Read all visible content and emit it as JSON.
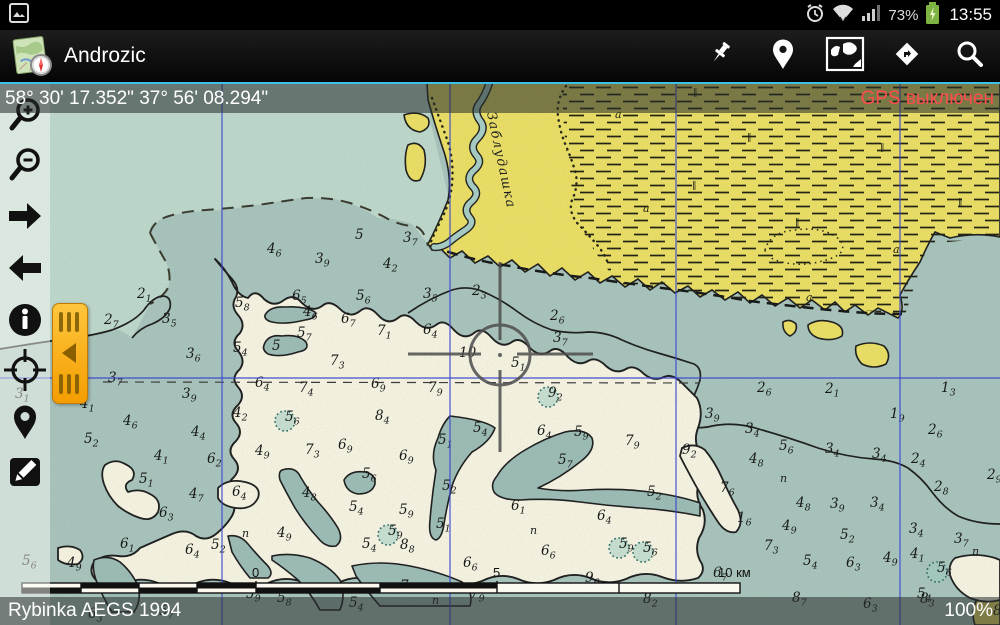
{
  "status_bar": {
    "time": "13:55",
    "battery_percent": "73%",
    "icons": [
      "screenshot-icon",
      "alarm-icon",
      "wifi-icon",
      "signal-icon",
      "battery-charging-icon"
    ]
  },
  "action_bar": {
    "title": "Androzic",
    "buttons": [
      {
        "name": "pushpin-button"
      },
      {
        "name": "place-button"
      },
      {
        "name": "maps-button"
      },
      {
        "name": "navigation-button"
      },
      {
        "name": "search-button"
      }
    ]
  },
  "coordinate_bar": {
    "coordinates": "58° 30' 17.352\" 37° 56' 08.294\"",
    "gps_status": "GPS выключен",
    "gps_color": "#ff4d4d"
  },
  "bottom_bar": {
    "map_name": "Rybinka AEGS 1994",
    "zoom_level": "100%"
  },
  "left_toolbar": [
    "zoom-in",
    "zoom-out",
    "move-right",
    "move-left",
    "info",
    "position",
    "place-mark",
    "edit"
  ],
  "map": {
    "river_label": "Заблудашка",
    "scale": {
      "marks": [
        {
          "x": 256,
          "label": "0"
        },
        {
          "x": 497,
          "label": "5"
        },
        {
          "x": 722,
          "label": "10 км"
        }
      ]
    },
    "grid": {
      "vertical_x": [
        222,
        450,
        676,
        900
      ],
      "horizontal_y": [
        378
      ],
      "color": "#3a46d4"
    },
    "colors": {
      "water": "#a9c4bc",
      "water_light": "#bfd8cc",
      "shallow": "#f8f4e2",
      "land": "#ecdf63",
      "channel": "#9dbcb6",
      "gps_red": "#ff4d4d",
      "accent_cyan": "#3ec1e8",
      "handle_orange": "#f7b000"
    },
    "soundings": [
      [
        104,
        324,
        "2",
        "7"
      ],
      [
        137,
        298,
        "2",
        "1"
      ],
      [
        162,
        323,
        "3",
        "5"
      ],
      [
        186,
        358,
        "3",
        "6"
      ],
      [
        108,
        382,
        "3",
        "7"
      ],
      [
        182,
        398,
        "3",
        "9"
      ],
      [
        15,
        398,
        "3",
        "1"
      ],
      [
        80,
        408,
        "4",
        "1"
      ],
      [
        84,
        443,
        "5",
        "2"
      ],
      [
        123,
        425,
        "4",
        "6"
      ],
      [
        191,
        436,
        "4",
        "4"
      ],
      [
        154,
        460,
        "4",
        "1"
      ],
      [
        207,
        463,
        "6",
        "2"
      ],
      [
        255,
        455,
        "4",
        "9"
      ],
      [
        139,
        483,
        "5",
        "1"
      ],
      [
        189,
        498,
        "4",
        "7"
      ],
      [
        159,
        517,
        "6",
        "3"
      ],
      [
        232,
        496,
        "6",
        "4"
      ],
      [
        120,
        548,
        "6",
        "1"
      ],
      [
        185,
        554,
        "6",
        "4"
      ],
      [
        211,
        549,
        "5",
        "2"
      ],
      [
        277,
        537,
        "4",
        "9"
      ],
      [
        267,
        253,
        "4",
        "6"
      ],
      [
        315,
        263,
        "3",
        "9"
      ],
      [
        355,
        239,
        "5",
        ""
      ],
      [
        403,
        242,
        "3",
        "7"
      ],
      [
        383,
        268,
        "4",
        "2"
      ],
      [
        423,
        298,
        "3",
        "5"
      ],
      [
        472,
        295,
        "2",
        "3"
      ],
      [
        550,
        320,
        "2",
        "6"
      ],
      [
        553,
        342,
        "3",
        "7"
      ],
      [
        459,
        357,
        "10",
        ""
      ],
      [
        511,
        367,
        "5",
        "1"
      ],
      [
        548,
        397,
        "9",
        "2"
      ],
      [
        235,
        307,
        "5",
        "8"
      ],
      [
        292,
        300,
        "6",
        "5"
      ],
      [
        303,
        316,
        "4",
        "6"
      ],
      [
        356,
        300,
        "5",
        "6"
      ],
      [
        341,
        323,
        "6",
        "7"
      ],
      [
        377,
        335,
        "7",
        "1"
      ],
      [
        423,
        334,
        "6",
        "4"
      ],
      [
        297,
        337,
        "5",
        "7"
      ],
      [
        272,
        350,
        "5",
        ""
      ],
      [
        233,
        352,
        "5",
        "4"
      ],
      [
        330,
        365,
        "7",
        "3"
      ],
      [
        255,
        387,
        "6",
        "4"
      ],
      [
        299,
        392,
        "7",
        "4"
      ],
      [
        371,
        388,
        "6",
        "9"
      ],
      [
        428,
        392,
        "7",
        "9"
      ],
      [
        233,
        417,
        "4",
        "2"
      ],
      [
        285,
        421,
        "5",
        "6"
      ],
      [
        375,
        420,
        "8",
        "4"
      ],
      [
        305,
        454,
        "7",
        "3"
      ],
      [
        338,
        449,
        "6",
        "9"
      ],
      [
        399,
        460,
        "6",
        "9"
      ],
      [
        362,
        478,
        "5",
        "6"
      ],
      [
        302,
        497,
        "4",
        "8"
      ],
      [
        349,
        511,
        "5",
        "4"
      ],
      [
        399,
        514,
        "5",
        "9"
      ],
      [
        388,
        535,
        "5",
        "9"
      ],
      [
        400,
        549,
        "8",
        "8"
      ],
      [
        362,
        548,
        "5",
        "4"
      ],
      [
        436,
        528,
        "5",
        "1"
      ],
      [
        442,
        490,
        "5",
        "2"
      ],
      [
        473,
        432,
        "5",
        "4"
      ],
      [
        438,
        444,
        "5",
        "1"
      ],
      [
        537,
        435,
        "6",
        "4"
      ],
      [
        574,
        436,
        "5",
        "9"
      ],
      [
        558,
        464,
        "5",
        "7"
      ],
      [
        511,
        510,
        "6",
        "1"
      ],
      [
        597,
        520,
        "6",
        "4"
      ],
      [
        647,
        496,
        "5",
        "2"
      ],
      [
        625,
        445,
        "7",
        "9"
      ],
      [
        682,
        454,
        "9",
        "2"
      ],
      [
        541,
        555,
        "6",
        "6"
      ],
      [
        619,
        548,
        "5",
        "9"
      ],
      [
        643,
        552,
        "5",
        "6"
      ],
      [
        757,
        392,
        "2",
        "6"
      ],
      [
        825,
        393,
        "2",
        "1"
      ],
      [
        941,
        392,
        "1",
        "3"
      ],
      [
        705,
        418,
        "3",
        "9"
      ],
      [
        890,
        418,
        "1",
        "9"
      ],
      [
        745,
        433,
        "3",
        "4"
      ],
      [
        928,
        434,
        "2",
        "6"
      ],
      [
        779,
        450,
        "5",
        "6"
      ],
      [
        825,
        453,
        "3",
        "4"
      ],
      [
        872,
        458,
        "3",
        "4"
      ],
      [
        911,
        463,
        "2",
        "4"
      ],
      [
        749,
        463,
        "4",
        "8"
      ],
      [
        987,
        479,
        "2",
        "9"
      ],
      [
        934,
        491,
        "2",
        "8"
      ],
      [
        720,
        492,
        "7",
        "6"
      ],
      [
        796,
        507,
        "4",
        "8"
      ],
      [
        830,
        508,
        "3",
        "9"
      ],
      [
        870,
        507,
        "3",
        "4"
      ],
      [
        737,
        522,
        "1",
        "6"
      ],
      [
        782,
        530,
        "4",
        "9"
      ],
      [
        840,
        539,
        "5",
        "2"
      ],
      [
        909,
        533,
        "3",
        "4"
      ],
      [
        954,
        543,
        "3",
        "7"
      ],
      [
        910,
        558,
        "4",
        "1"
      ],
      [
        764,
        550,
        "7",
        "3"
      ],
      [
        22,
        565,
        "5",
        "6"
      ],
      [
        67,
        567,
        "4",
        "9"
      ],
      [
        88,
        618,
        "6",
        "3"
      ],
      [
        159,
        615,
        "5",
        "7"
      ],
      [
        246,
        598,
        "5",
        "9"
      ],
      [
        277,
        602,
        "5",
        "8"
      ],
      [
        349,
        607,
        "5",
        "4"
      ],
      [
        400,
        590,
        "7",
        "3"
      ],
      [
        470,
        598,
        "7",
        "9"
      ],
      [
        463,
        567,
        "6",
        "6"
      ],
      [
        585,
        582,
        "9",
        "6"
      ],
      [
        643,
        603,
        "8",
        "2"
      ],
      [
        713,
        577,
        "6",
        "7"
      ],
      [
        803,
        565,
        "5",
        "4"
      ],
      [
        846,
        567,
        "6",
        "3"
      ],
      [
        883,
        562,
        "4",
        "9"
      ],
      [
        937,
        572,
        "5",
        "6"
      ],
      [
        917,
        598,
        "5",
        "4"
      ],
      [
        863,
        608,
        "6",
        "3"
      ],
      [
        920,
        603,
        "8",
        "3"
      ],
      [
        792,
        602,
        "8",
        "7"
      ],
      [
        993,
        615,
        "8",
        "2"
      ]
    ],
    "pi_marks": [
      [
        530,
        534
      ],
      [
        780,
        482
      ],
      [
        972,
        555
      ],
      [
        432,
        604
      ],
      [
        242,
        537
      ]
    ],
    "stipples": [
      [
        285,
        421
      ],
      [
        388,
        535
      ],
      [
        619,
        548
      ],
      [
        643,
        552
      ],
      [
        548,
        397
      ],
      [
        937,
        572
      ]
    ],
    "marsh_marks": [
      [
        693,
        95
      ],
      [
        747,
        140
      ],
      [
        692,
        188
      ],
      [
        880,
        150
      ],
      [
        795,
        225
      ],
      [
        958,
        205
      ]
    ],
    "alpha_marks": [
      [
        615,
        118
      ],
      [
        643,
        212
      ],
      [
        893,
        253
      ],
      [
        806,
        301
      ]
    ]
  }
}
